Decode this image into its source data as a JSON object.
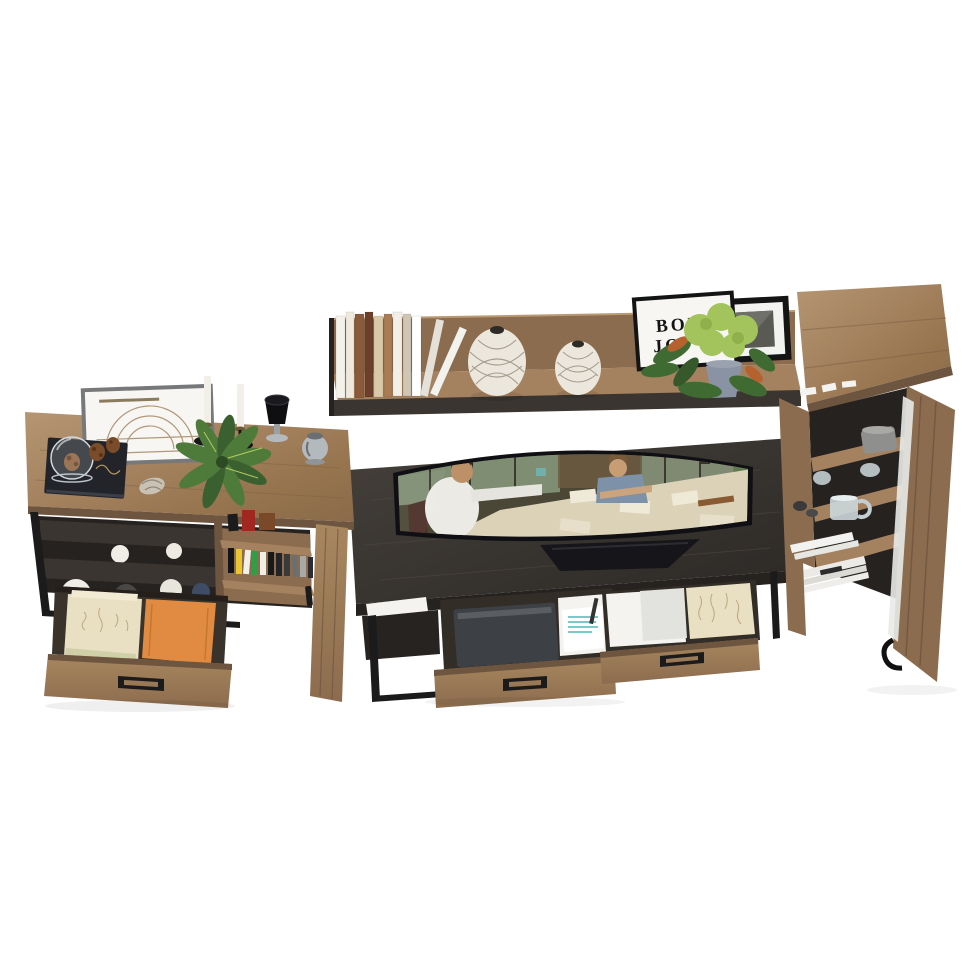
{
  "frame_print": {
    "line1": "BON",
    "line2": "JO"
  },
  "palette": {
    "bg": "#ffffff",
    "wood_top": "#a5825f",
    "wood_light": "#b1916c",
    "wood_mid": "#8c6c4e",
    "wood_dark": "#6e5540",
    "wood_deep": "#57422f",
    "espresso": "#3a3531",
    "espresso_light": "#4a443d",
    "espresso_dark": "#262220",
    "metal": "#1b1b1b",
    "white_paper": "#f4f3ef",
    "grey_paper": "#e2e2de",
    "orange_folder": "#e08a42",
    "beige_folder": "#e9dfc3",
    "teal_ink": "#7bcaca",
    "tablet": "#3d4145",
    "glass": "#ccd7db",
    "pot": "#8a93a3",
    "leaf_dark": "#3f6b33",
    "leaf_mid": "#4e7a3a",
    "bloom": "#a3c45c",
    "leaf_orange": "#b5622f",
    "vase_cream": "#ece7dc",
    "lattice": "#8d8474",
    "frame_black": "#141414",
    "frame_grey": "#77787a",
    "frame_white": "#f7f6f3",
    "red_book": "#a02820",
    "brown_box": "#7a4a28",
    "screen_bg": "#4b4736",
    "screen_window": "#8ca083",
    "screen_table": "#dcd2b8",
    "shirt": "#eceae4",
    "skin": "#bd9168",
    "denim": "#7d92a8",
    "hair_dark": "#2e2218",
    "hair_brown": "#7a5936",
    "chair_red": "#4a2f28",
    "machine_green": "#5e7a4e",
    "silver": "#b4b9bd",
    "black_decor": "#0f0f12",
    "pinecone": "#7a4c2a",
    "gold": "#b89a5e",
    "grey_bin": "#8f8f8d"
  },
  "shelf_books": {
    "count": 11,
    "colors": [
      "#f4f1ea",
      "#efe9dd",
      "#8a5a3a",
      "#6b3f2a",
      "#d9c9a8",
      "#a97c54",
      "#f2efe8",
      "#cfc6b4",
      "#ffffff",
      "#e5e1d8",
      "#f4f2ec"
    ]
  },
  "media_cases": {
    "count": 11,
    "colors": [
      "#14141c",
      "#e8c531",
      "#f2f0e8",
      "#2f9e44",
      "#f0eee6",
      "#191919",
      "#23232a",
      "#3a3a3a",
      "#6e6e6e",
      "#a8a8a8",
      "#2b2b31"
    ]
  },
  "decor_spheres": {
    "colors": [
      "#f0ede6",
      "#edeae2",
      "#f0ede6",
      "#4a4846",
      "#e8e5dd",
      "#3e4c66"
    ]
  }
}
